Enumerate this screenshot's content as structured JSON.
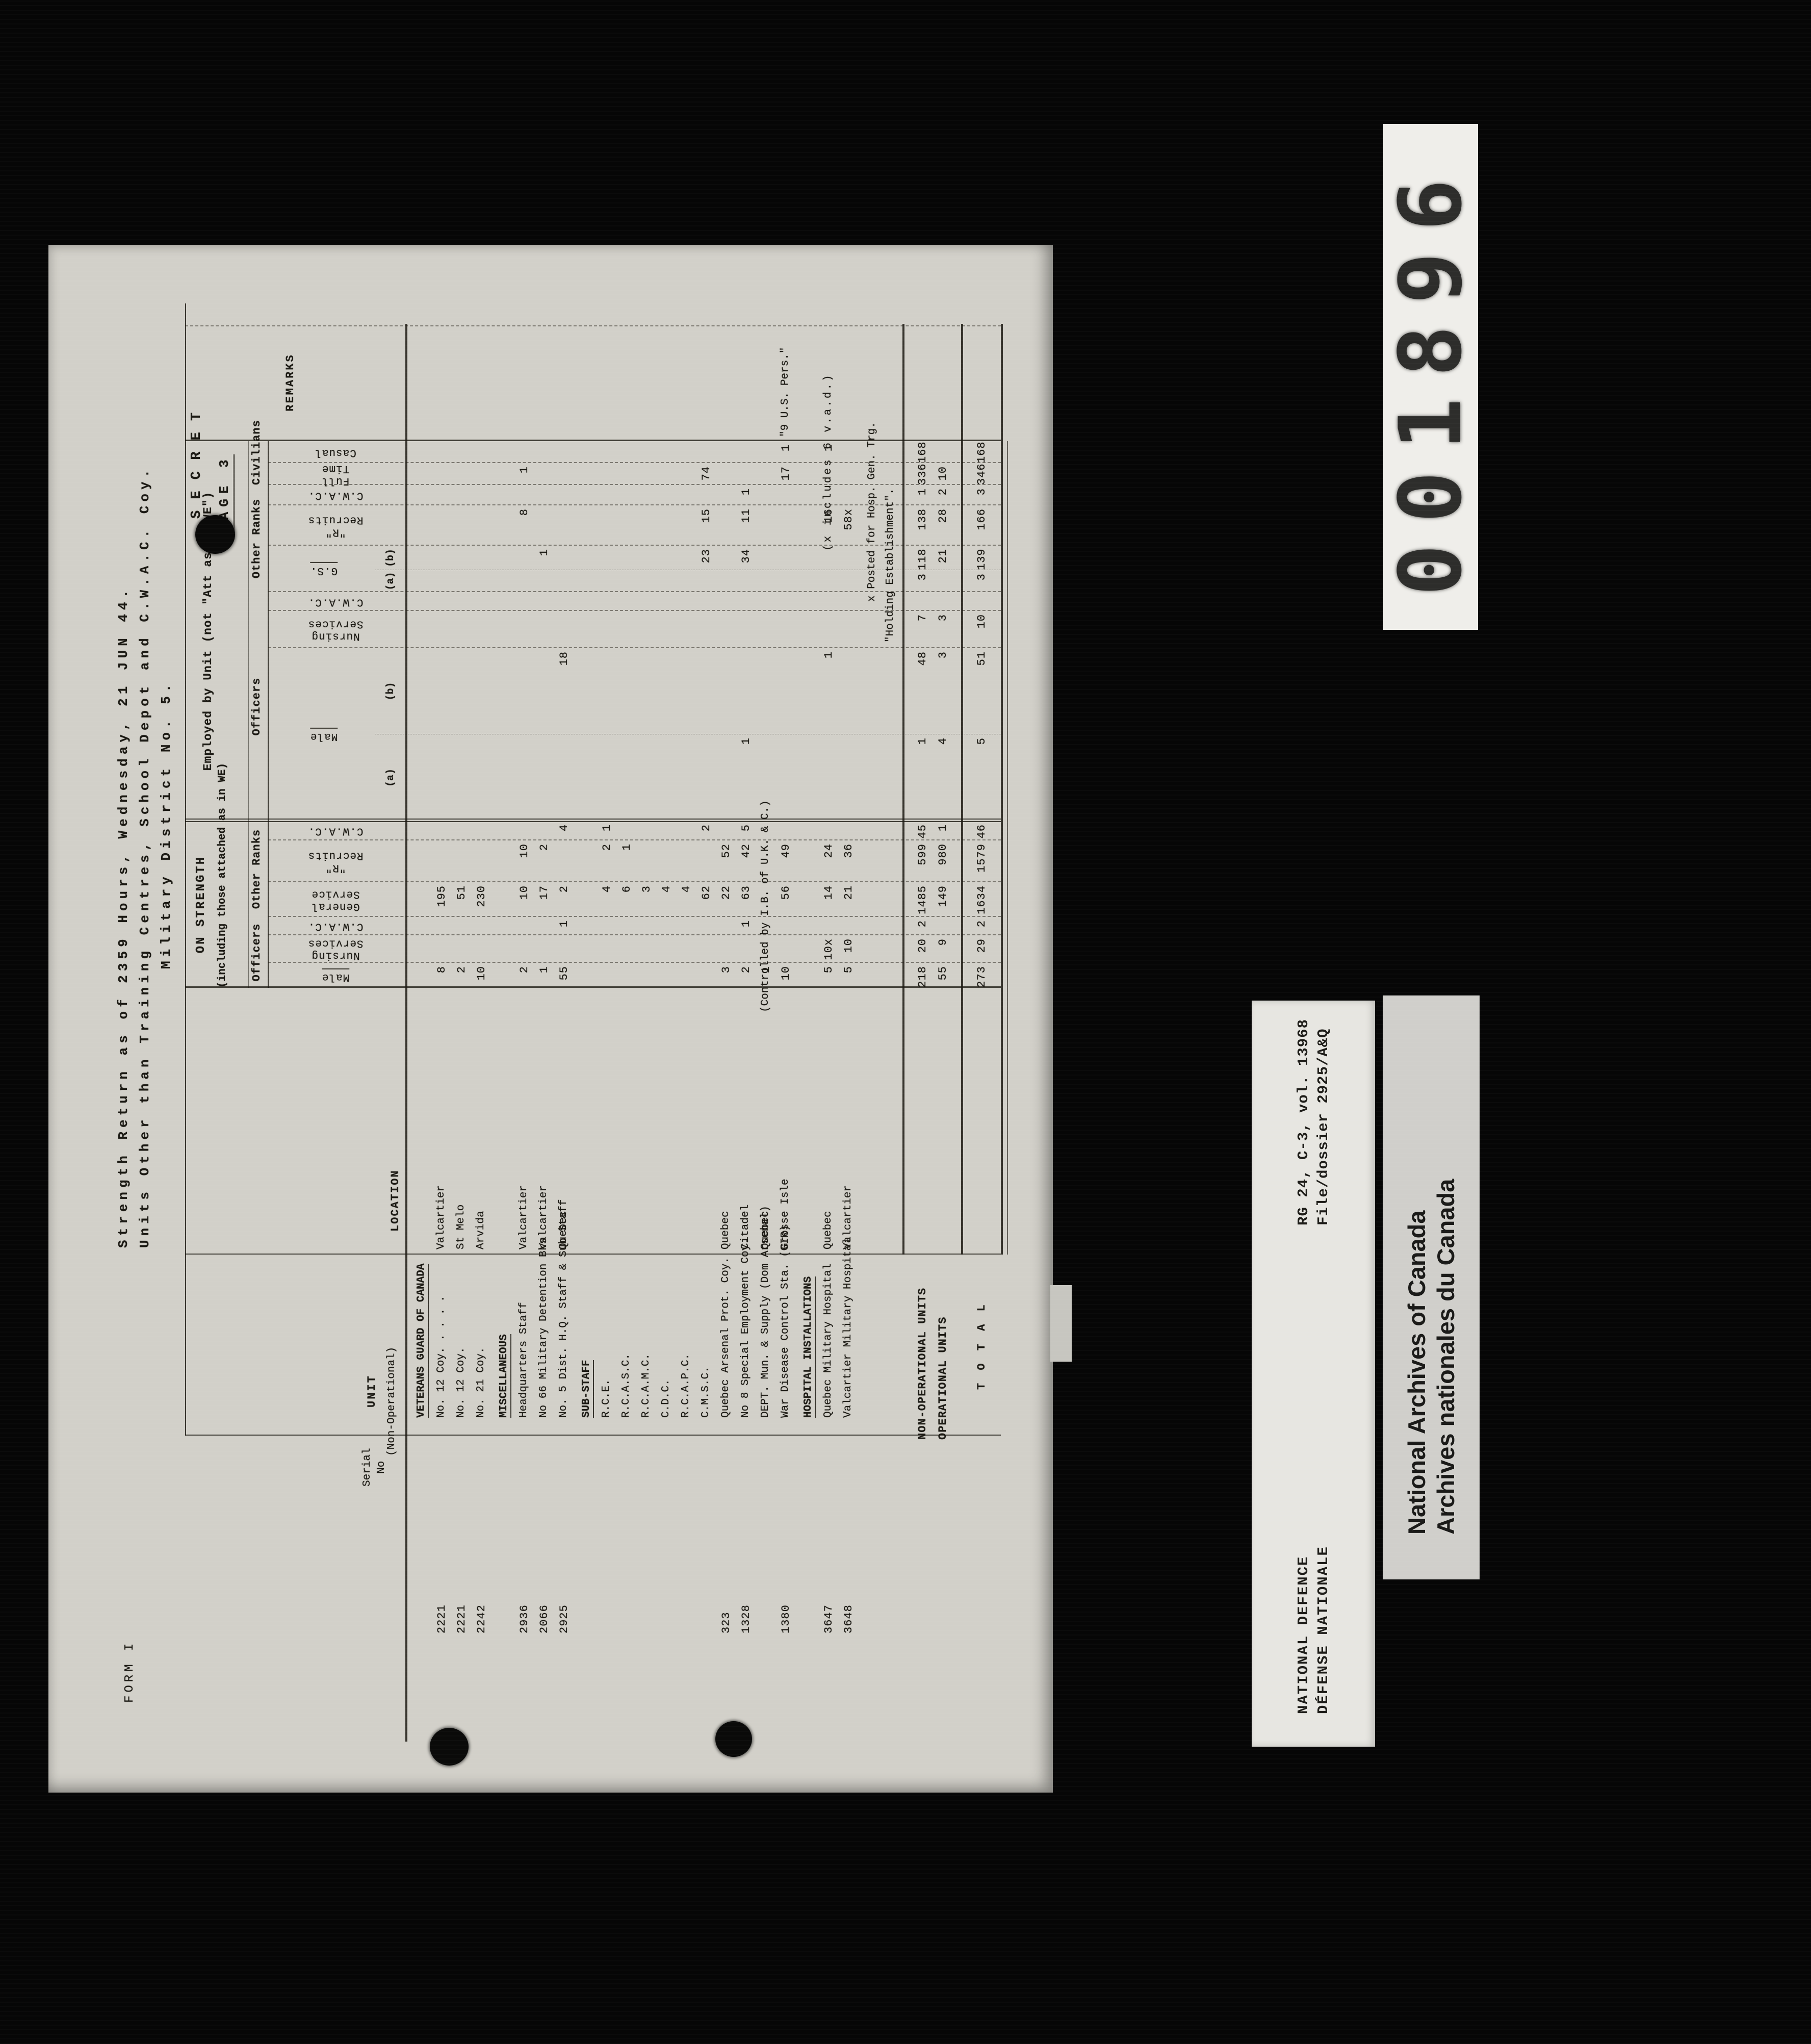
{
  "frame": {
    "counter_digits": "001896",
    "cards": {
      "rg_reference": {
        "line1": "RG 24, C-3, vol. 13968",
        "line2": "File/dossier 2925/A&Q"
      },
      "defence": {
        "line1": "NATIONAL DEFENCE",
        "line2": "DÉFENSE NATIONALE"
      },
      "archives": {
        "line1": "National Archives of Canada",
        "line2": "Archives nationales du Canada"
      }
    }
  },
  "form": {
    "form_no": "FORM I",
    "classification": "S E C R E T",
    "page_label": "PAGE 3",
    "title_lines": [
      "Strength Return as of 2359 Hours, Wednesday, 21 JUN 44.",
      "Units Other than Training Centres, School Depot and C.W.A.C. Coy.",
      "Military District No. 5."
    ],
    "sections": {
      "on_strength_title": "ON STRENGTH",
      "on_strength_sub": "(including those attached as in WE)",
      "employed_title": "Employed by Unit (not \"Att as in WE\")"
    },
    "group_labels": [
      "Officers",
      "Other Ranks",
      "Officers",
      "Other Ranks",
      "Civilians"
    ],
    "left_headers": {
      "serial": "Serial\nNo",
      "unit": "UNIT",
      "unit_sub": "(Non-Operational)",
      "location": "LOCATION",
      "remarks": "REMARKS"
    },
    "columns": [
      {
        "key": "os_male",
        "label": "Male",
        "underline": true
      },
      {
        "key": "os_nursing",
        "label": "Nursing\nServices"
      },
      {
        "key": "os_cwac_off",
        "label": "C.W.A.C."
      },
      {
        "key": "os_gs",
        "label": "General\nService"
      },
      {
        "key": "os_r",
        "label": "\"R\"\nRecruits"
      },
      {
        "key": "os_cwac_or",
        "label": "C.W.A.C."
      },
      {
        "key": "e_male",
        "label": "Male",
        "underline": true,
        "subs": [
          "(a)",
          "(b)"
        ]
      },
      {
        "key": "e_nursing",
        "label": "Nursing\nServices"
      },
      {
        "key": "e_cwac_off",
        "label": "C.W.A.C."
      },
      {
        "key": "e_gs",
        "label": "G.S.",
        "underline": true,
        "subs": [
          "(a)",
          "(b)"
        ]
      },
      {
        "key": "e_r",
        "label": "\"R\"\nRecruits"
      },
      {
        "key": "e_cwac_or",
        "label": "C.W.A.C."
      },
      {
        "key": "full_time",
        "label": "Full Time"
      },
      {
        "key": "casual",
        "label": "Casual"
      }
    ],
    "rows": [
      {
        "type": "heading",
        "unit": "VETERANS GUARD OF CANADA"
      },
      {
        "type": "data",
        "serial": "2221",
        "unit": "No. 12 Coy.",
        "dots": "  .   .   .   .",
        "location": "Valcartier",
        "values": {
          "os_male": "8",
          "os_gs": "195"
        }
      },
      {
        "type": "data",
        "serial": "2221",
        "unit": "No. 12 Coy.",
        "location": "St Melo",
        "values": {
          "os_male": "2",
          "os_gs": "51"
        }
      },
      {
        "type": "data",
        "serial": "2242",
        "unit": "No. 21 Coy.",
        "location": "Arvida",
        "values": {
          "os_male": "10",
          "os_gs": "230"
        }
      },
      {
        "type": "heading",
        "unit": "MISCELLANEOUS"
      },
      {
        "type": "data",
        "serial": "2936",
        "unit": "Headquarters Staff",
        "location": "Valcartier",
        "values": {
          "os_male": "2",
          "os_gs": "10",
          "os_r": "10",
          "e_r": "8",
          "full_time": "1"
        }
      },
      {
        "type": "data",
        "serial": "2066",
        "unit": "No 66 Military Detention Bks",
        "location": "Valcartier",
        "values": {
          "os_male": "1",
          "os_gs": "17",
          "os_r": "2",
          "e_gs_b": "1"
        }
      },
      {
        "type": "data",
        "serial": "2925",
        "unit": "No. 5 Dist. H.Q. Staff & Sub-Staff",
        "location": "Quebec",
        "values": {
          "os_male": "55",
          "os_cwac_off": "1",
          "os_gs": "2",
          "os_cwac_or": "4",
          "e_male_b": "18"
        }
      },
      {
        "type": "heading",
        "unit": "SUB-STAFF"
      },
      {
        "type": "data",
        "unit": "R.C.E.",
        "values": {
          "os_gs": "4",
          "os_r": "2",
          "os_cwac_or": "1"
        }
      },
      {
        "type": "data",
        "unit": "R.C.A.S.C.",
        "values": {
          "os_gs": "6",
          "os_r": "1"
        }
      },
      {
        "type": "data",
        "unit": "R.C.A.M.C.",
        "values": {
          "os_gs": "3"
        }
      },
      {
        "type": "data",
        "unit": "C.D.C.",
        "values": {
          "os_gs": "4"
        }
      },
      {
        "type": "data",
        "unit": "R.C.A.P.C.",
        "values": {
          "os_gs": "4"
        }
      },
      {
        "type": "data",
        "unit": "C.M.S.C.",
        "values": {
          "os_gs": "62",
          "os_cwac_or": "2",
          "e_r": "15",
          "e_gs_b": "23",
          "full_time": "74"
        }
      },
      {
        "type": "data",
        "serial": "323",
        "unit": "Quebec Arsenal Prot. Coy.",
        "location": "Quebec",
        "values": {
          "os_male": "3",
          "os_gs": "22",
          "os_r": "52"
        }
      },
      {
        "type": "data",
        "serial": "1328",
        "unit": "No 8 Special Employment Coy.",
        "location": "Citadel",
        "values": {
          "os_male": "2",
          "os_cwac_off": "1",
          "os_gs": "63",
          "os_r": "42",
          "os_cwac_or": "5",
          "e_male_a": "1",
          "e_cwac_or": "1",
          "e_r": "11",
          "e_gs_b": "34"
        }
      },
      {
        "type": "data",
        "unit": "DEPT. Mun. & Supply (Dom Arsenal)",
        "location": "Quebec",
        "values": {
          "os_male": "1"
        },
        "span_note": "(Controlled by I.B. of U.K. & C.)"
      },
      {
        "type": "data",
        "serial": "1380",
        "unit": "War Disease Control Sta. (GIR)",
        "location": "Grosse Isle",
        "values": {
          "os_male": "10",
          "os_gs": "56",
          "os_r": "49",
          "full_time": "17",
          "casual": "1"
        },
        "remark": "\"9 U.S. Pers.\""
      },
      {
        "type": "heading",
        "unit": "HOSPITAL INSTALLATIONS"
      },
      {
        "type": "data",
        "serial": "3647",
        "unit": "Quebec Military Hospital",
        "location": "Quebec",
        "values": {
          "os_male": "5",
          "os_nursing": "10x",
          "os_gs": "14",
          "os_r": "24",
          "e_male_b": "1",
          "e_r": "16",
          "casual": "1"
        },
        "overlay_remark": "(x includes 6 v.a.d.)"
      },
      {
        "type": "data",
        "serial": "3648",
        "unit": "Valcartier Military Hospital",
        "location": "Valcartier",
        "values": {
          "os_male": "5",
          "os_nursing": "10",
          "os_gs": "21",
          "os_r": "36",
          "e_r": "58x"
        }
      }
    ],
    "footnote_lines": [
      "x Posted for Hosp. Gen. Trg.",
      "\"Holding Establishment\"."
    ],
    "totals": [
      {
        "type": "total",
        "unit": "NON-OPERATIONAL UNITS",
        "values": {
          "os_male": "218",
          "os_nursing": "20",
          "os_cwac_off": "2",
          "os_gs": "1485",
          "os_r": "599",
          "os_cwac_or": "45",
          "e_male_a": "1",
          "e_male_b": "48",
          "e_nursing": "7",
          "e_gs_a": "3",
          "e_gs_b": "118",
          "e_r": "138",
          "e_cwac_or": "1",
          "full_time": "336",
          "casual": "168"
        }
      },
      {
        "type": "total",
        "unit": "OPERATIONAL UNITS",
        "values": {
          "os_male": "55",
          "os_nursing": "9",
          "os_gs": "149",
          "os_r": "980",
          "os_cwac_or": "1",
          "e_male_a": "4",
          "e_male_b": "3",
          "e_nursing": "3",
          "e_gs_b": "21",
          "e_r": "28",
          "e_cwac_or": "2",
          "full_time": "10"
        }
      },
      {
        "type": "grand",
        "unit": "T O T A L",
        "values": {
          "os_male": "273",
          "os_nursing": "29",
          "os_cwac_off": "2",
          "os_gs": "1634",
          "os_r": "1579",
          "os_cwac_or": "46",
          "e_male_a": "5",
          "e_male_b": "51",
          "e_nursing": "10",
          "e_gs_a": "3",
          "e_gs_b": "139",
          "e_r": "166",
          "e_cwac_or": "3",
          "full_time": "346",
          "casual": "168"
        }
      }
    ]
  }
}
